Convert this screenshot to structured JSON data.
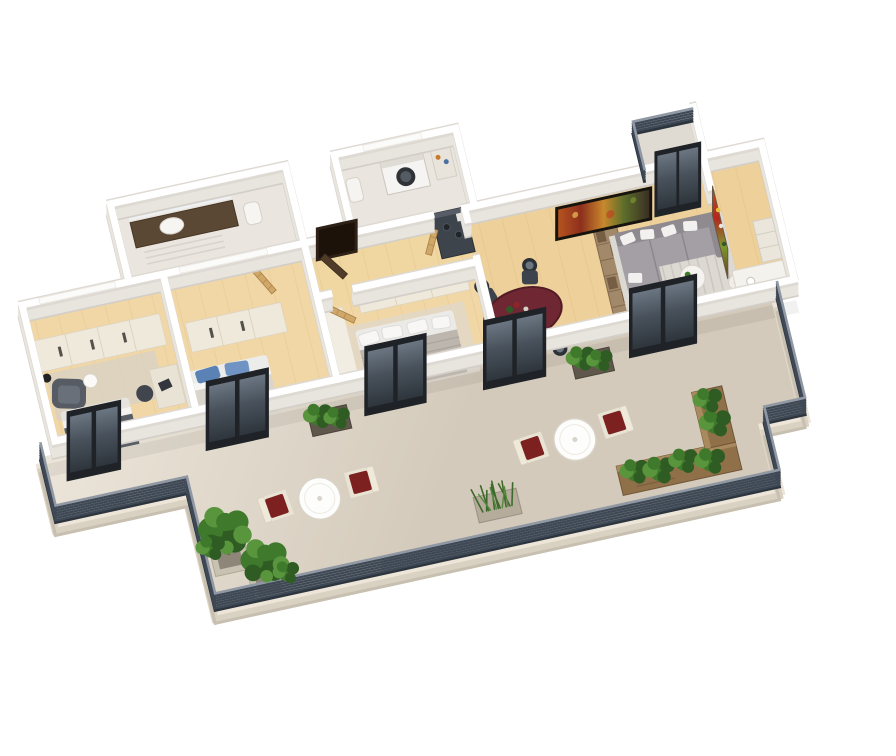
{
  "scene": {
    "title": "3D apartment floor plan render",
    "view": "isometric three-quarter top-down",
    "background": "#ffffff",
    "description": "Photorealistic 3D floor plan of a three-bedroom apartment with a large wrap-around terrace, black-framed balcony doors and dark slatted railing"
  },
  "palette": {
    "wall": "#ffffff",
    "wallSide": "#e8e5df",
    "floorWood": "#f1d7a5",
    "floorDining": "#eed09a",
    "floorBath": "#eae6df",
    "terraceFloor": "#e9e2d6",
    "terraceFloorDark": "#d3cabb",
    "slab": "#ece5d8",
    "railing": "#3f4956",
    "railingTop": "#8f98a3",
    "frame": "#1f2327",
    "glassTop": "#59646f",
    "glassBottom": "#2e353c",
    "wood": "#8f7049",
    "foliage": "#3f7a2c",
    "foliageDark": "#2e5c23",
    "foliageLight": "#58953c",
    "cushionRed": "#7c2020",
    "sofa": "#a39fa4",
    "diningTable": "#6e2733",
    "bedBlanket": "#595e66",
    "pillowBlue": "#5b82b5",
    "cream": "#efe9dc",
    "vanity": "#5a4734"
  },
  "rooms": [
    {
      "id": "bedroom-1",
      "label": "Bedroom 1",
      "furniture": [
        "sliding wardrobe",
        "double bed with dark gray blanket",
        "dark armchair",
        "floor lamp",
        "round side table",
        "desk with office chair",
        "gray rug"
      ]
    },
    {
      "id": "bedroom-2",
      "label": "Bedroom 2",
      "furniture": [
        "sliding wardrobe",
        "double bed with blue pillows"
      ]
    },
    {
      "id": "bathroom",
      "label": "Bathroom",
      "furniture": [
        "dark wood vanity",
        "sink",
        "toilet",
        "towel rail"
      ]
    },
    {
      "id": "hallway",
      "label": "Hallway",
      "furniture": [
        "entry door",
        "three wooden interior doors",
        "kitchenette counter with cooktop"
      ]
    },
    {
      "id": "master-bedroom",
      "label": "Master bedroom",
      "furniture": [
        "sliding wardrobe",
        "tall white cabinet",
        "king bed with striped duvet",
        "rug"
      ]
    },
    {
      "id": "laundry",
      "label": "Laundry / utility room",
      "furniture": [
        "washing machine",
        "small sink",
        "shelf"
      ]
    },
    {
      "id": "dining-area",
      "label": "Dining area",
      "furniture": [
        "oval burgundy table",
        "4 dark chairs",
        "tableware"
      ]
    },
    {
      "id": "living-room",
      "label": "Living room",
      "furniture": [
        "L-shaped gray sofa with white pillows",
        "round coffee table with plant",
        "side table",
        "striped rug",
        "wall TV with colorful screen",
        "wooden shelf divider"
      ]
    },
    {
      "id": "kitchen",
      "label": "Kitchen corner",
      "furniture": [
        "tall colorful unit",
        "white counter",
        "shelf"
      ]
    },
    {
      "id": "rear-balcony",
      "label": "Rear balcony",
      "furniture": [
        "dark slatted railing",
        "black glass door"
      ]
    }
  ],
  "terrace": {
    "label": "Wrap-around terrace",
    "railing": "dark slatted metal railing",
    "items": [
      "round bistro table A with two red-cushion chairs",
      "round bistro table B with two red-cushion chairs",
      "L-shaped wooden planter bench with shrubs",
      "ornamental grass planter",
      "two potted trees at the corner",
      "two facade planter boxes with green plants"
    ]
  },
  "openings": {
    "front_balcony_doors": 5,
    "rear_balcony_door": 1,
    "entry_door": 1,
    "interior_wood_doors": 3,
    "back_windows": 3
  }
}
